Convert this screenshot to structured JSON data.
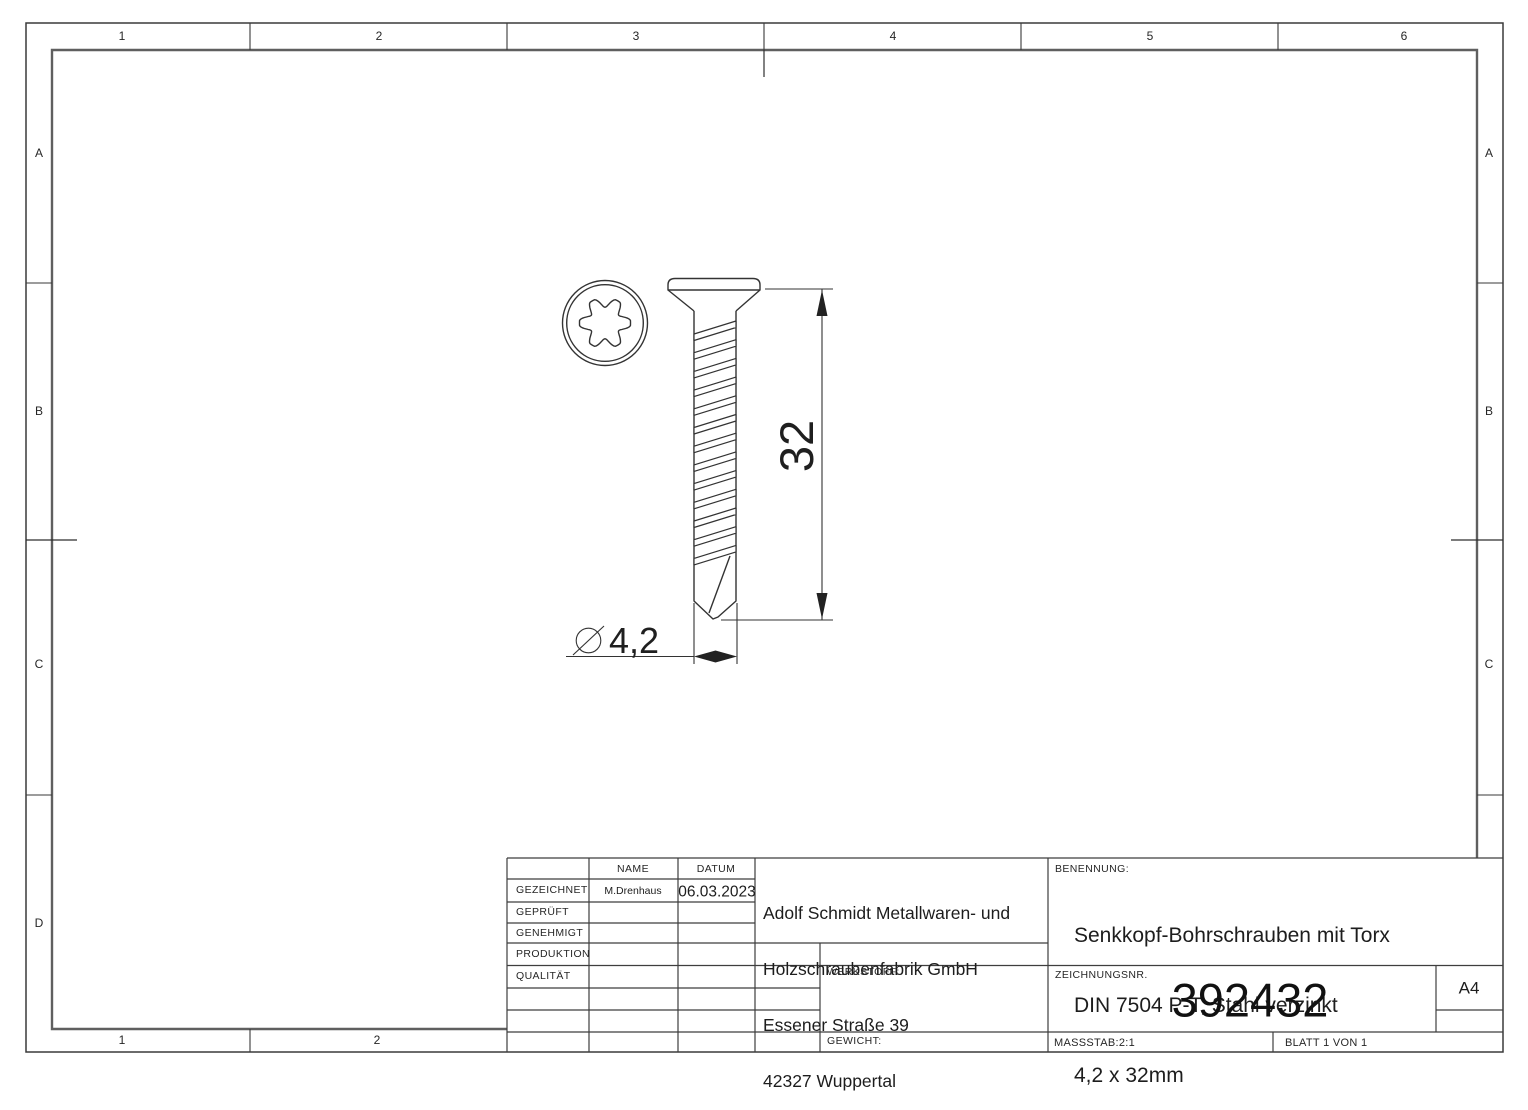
{
  "border": {
    "top_labels": [
      "1",
      "2",
      "3",
      "4",
      "5",
      "6"
    ],
    "bottom_labels": [
      "1",
      "2"
    ],
    "row_labels": [
      "A",
      "B",
      "C",
      "D"
    ]
  },
  "view": {
    "length_dim": "32",
    "dia_dim": "4,2"
  },
  "title_block": {
    "header_name": "NAME",
    "header_date": "DATUM",
    "rows": [
      {
        "label": "GEZEICHNET",
        "name": "M.Drenhaus",
        "date": "06.03.2023"
      },
      {
        "label": "GEPRÜFT",
        "name": "",
        "date": ""
      },
      {
        "label": "GENEHMIGT",
        "name": "",
        "date": ""
      },
      {
        "label": "PRODUKTION",
        "name": "",
        "date": ""
      },
      {
        "label": "QUALITÄT",
        "name": "",
        "date": ""
      }
    ],
    "company_lines": [
      "Adolf Schmidt Metallwaren- und",
      "Holzschraubenfabrik GmbH",
      "Essener Straße 39",
      "42327 Wuppertal"
    ],
    "werkstoff_label": "WERKSTOFF:",
    "gewicht_label": "GEWICHT:",
    "benennung_label": "BENENNUNG:",
    "benennung_lines": [
      "Senkkopf-Bohrschrauben mit Torx",
      "DIN 7504 P-T, Stahl verzinkt",
      "4,2 x 32mm"
    ],
    "zeichnungsnr_label": "ZEICHNUNGSNR.",
    "zeichnungsnr_value": "392432",
    "paper_format": "A4",
    "massstab": "MASSSTAB:2:1",
    "blatt": "BLATT 1 VON 1"
  }
}
